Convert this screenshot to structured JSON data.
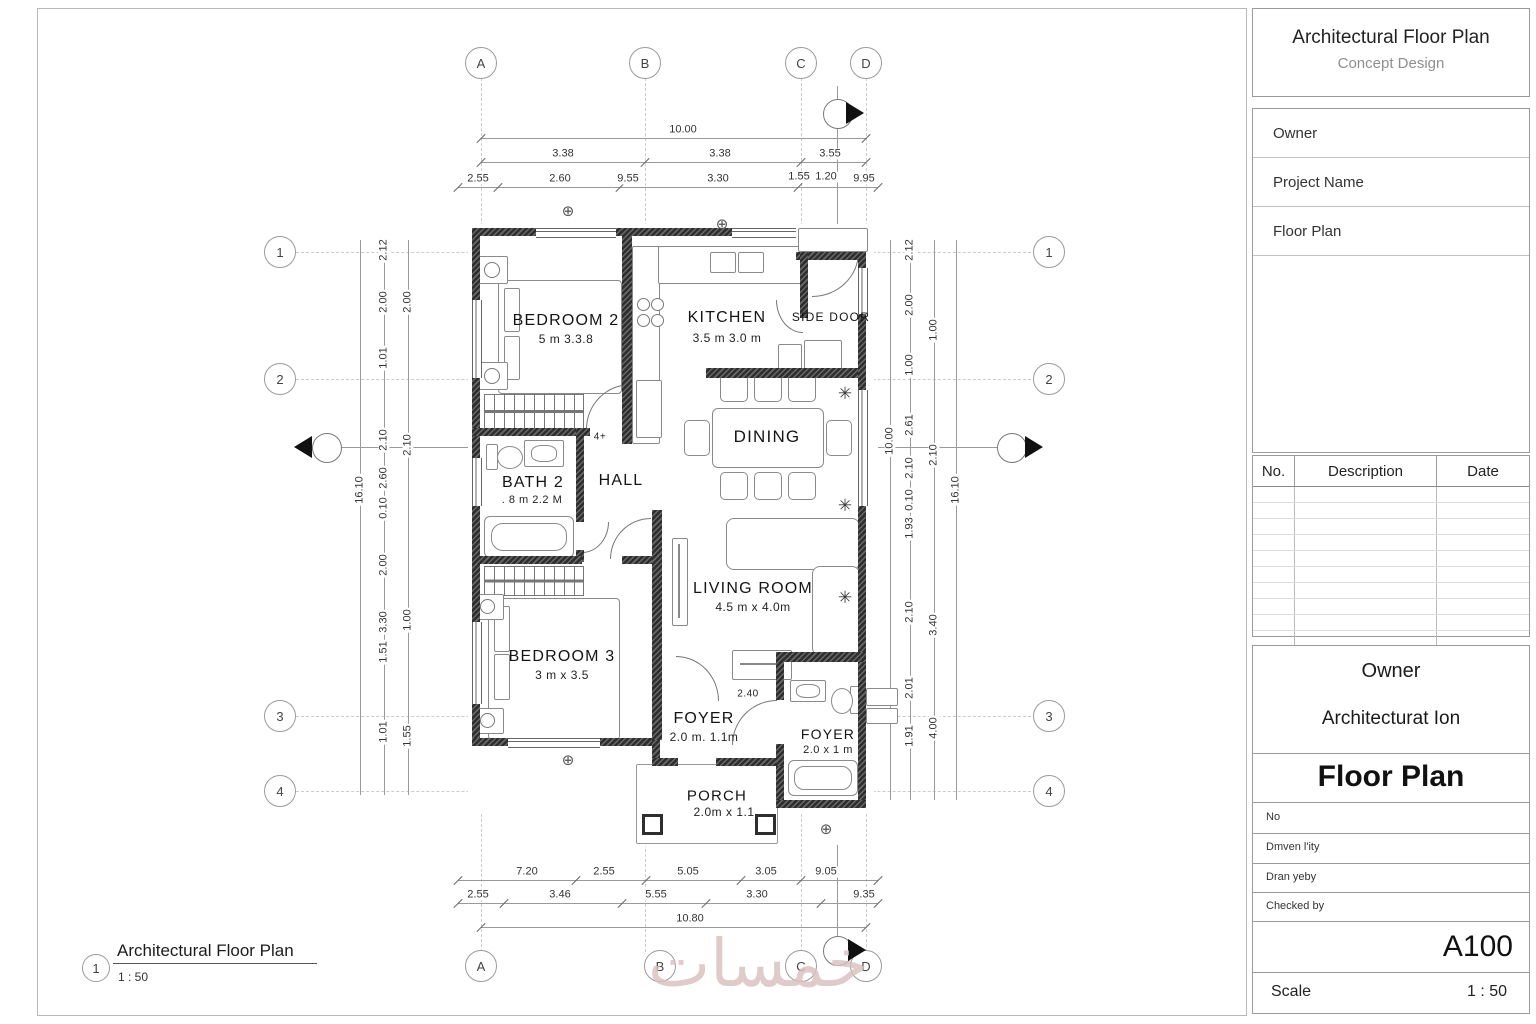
{
  "title_block": {
    "title": "Architectural Floor Plan",
    "subtitle": "Concept Design",
    "fields": [
      "Owner",
      "Project Name",
      "Floor Plan"
    ],
    "revision": {
      "no": "No.",
      "description": "Description",
      "date": "Date",
      "empty_rows": 10
    },
    "stamp": {
      "client": "Owner",
      "project": "Architecturat Ion",
      "sheet_name": "Floor Plan",
      "no_label": "No",
      "row1": "Dmven l'ity",
      "row2": "Dran yeby",
      "row3": "Checked by",
      "sheet_number": "A100",
      "scale_label": "Scale",
      "scale_value": "1 : 50"
    }
  },
  "view": {
    "number": "1",
    "title": "Architectural Floor Plan",
    "scale": "1 : 50"
  },
  "watermark": "خمسات",
  "grid": {
    "cols": [
      "A",
      "B",
      "C",
      "D"
    ],
    "rows": [
      "1",
      "2",
      "3",
      "4"
    ]
  },
  "rooms": {
    "bedroom2": {
      "name": "BEDROOM 2",
      "size": "5 m 3.3.8"
    },
    "kitchen": {
      "name": "KITCHEN",
      "size": "3.5 m 3.0 m"
    },
    "side_door": {
      "name": "SIDE DOOR"
    },
    "dining": {
      "name": "DINING"
    },
    "bath2": {
      "name": "BATH 2",
      "size": ". 8 m 2.2 M"
    },
    "hall": {
      "name": "HALL"
    },
    "living": {
      "name": "LIVING ROOM",
      "size": "4.5 m x 4.0m"
    },
    "bedroom3": {
      "name": "BEDROOM 3",
      "size": "3 m x 3.5"
    },
    "foyer1": {
      "name": "FOYER",
      "size": "2.0 m. 1.1m"
    },
    "foyer2": {
      "name": "FOYER",
      "size": "2.0 x 1 m"
    },
    "porch": {
      "name": "PORCH",
      "size": "2.0m x 1.1"
    }
  },
  "dims": {
    "top": {
      "overall": "10.00",
      "row2": [
        "3.38",
        "3.38",
        "3.55"
      ],
      "row3": [
        "2.55",
        "2.60",
        "9.55",
        "3.30",
        "1.55",
        "1.20",
        "9.95"
      ]
    },
    "bottom": {
      "row1": [
        "7.20",
        "2.55",
        "5.05",
        "3.05",
        "9.05"
      ],
      "row2": [
        "2.55",
        "3.46",
        "5.55",
        "3.30",
        "9.35"
      ],
      "overall": "10.80"
    },
    "left": {
      "overall": "16.10",
      "chain1": [
        "2.12",
        "2.00",
        "1.01",
        "2.10",
        "2.60",
        "0.10",
        "2.00",
        "3.30",
        "1.51",
        "1.01"
      ],
      "chain2": [
        "2.00",
        "2.10",
        "1.00",
        "1.55"
      ]
    },
    "right": {
      "overall": "16.10",
      "overall2": "10.00",
      "chain1": [
        "2.12",
        "2.00",
        "1.00",
        "2.61",
        "2.10",
        "0.10",
        "1.93",
        "2.10",
        "2.01",
        "1.91"
      ],
      "chain2": [
        "1.00",
        "2.10",
        "3.40",
        "4.00"
      ]
    },
    "inline": {
      "foyer_width": "2.40",
      "door_tag": "4+"
    }
  },
  "symbols": {
    "centerline": "⊕",
    "plant": "✳"
  }
}
